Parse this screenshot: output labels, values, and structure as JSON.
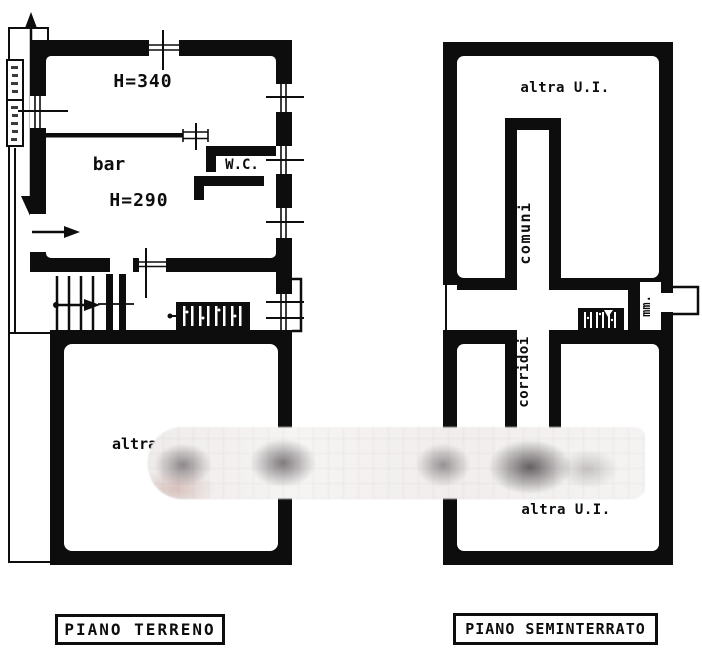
{
  "colors": {
    "ink": "#0d0d0d",
    "paper": "#ffffff"
  },
  "ground_floor": {
    "title": "PIANO TERRENO",
    "labels": {
      "upper_room_height": "H=340",
      "bar": "bar",
      "bar_height": "H=290",
      "wc": "W.C.",
      "lower_room": "altra"
    }
  },
  "basement": {
    "title": "PIANO SEMINTERRATO",
    "labels": {
      "upper_room": "altra U.I.",
      "common_stair": "comuni",
      "corridor": "corridoi",
      "small_room": "mm.",
      "lower_room": "altra U.I."
    }
  }
}
